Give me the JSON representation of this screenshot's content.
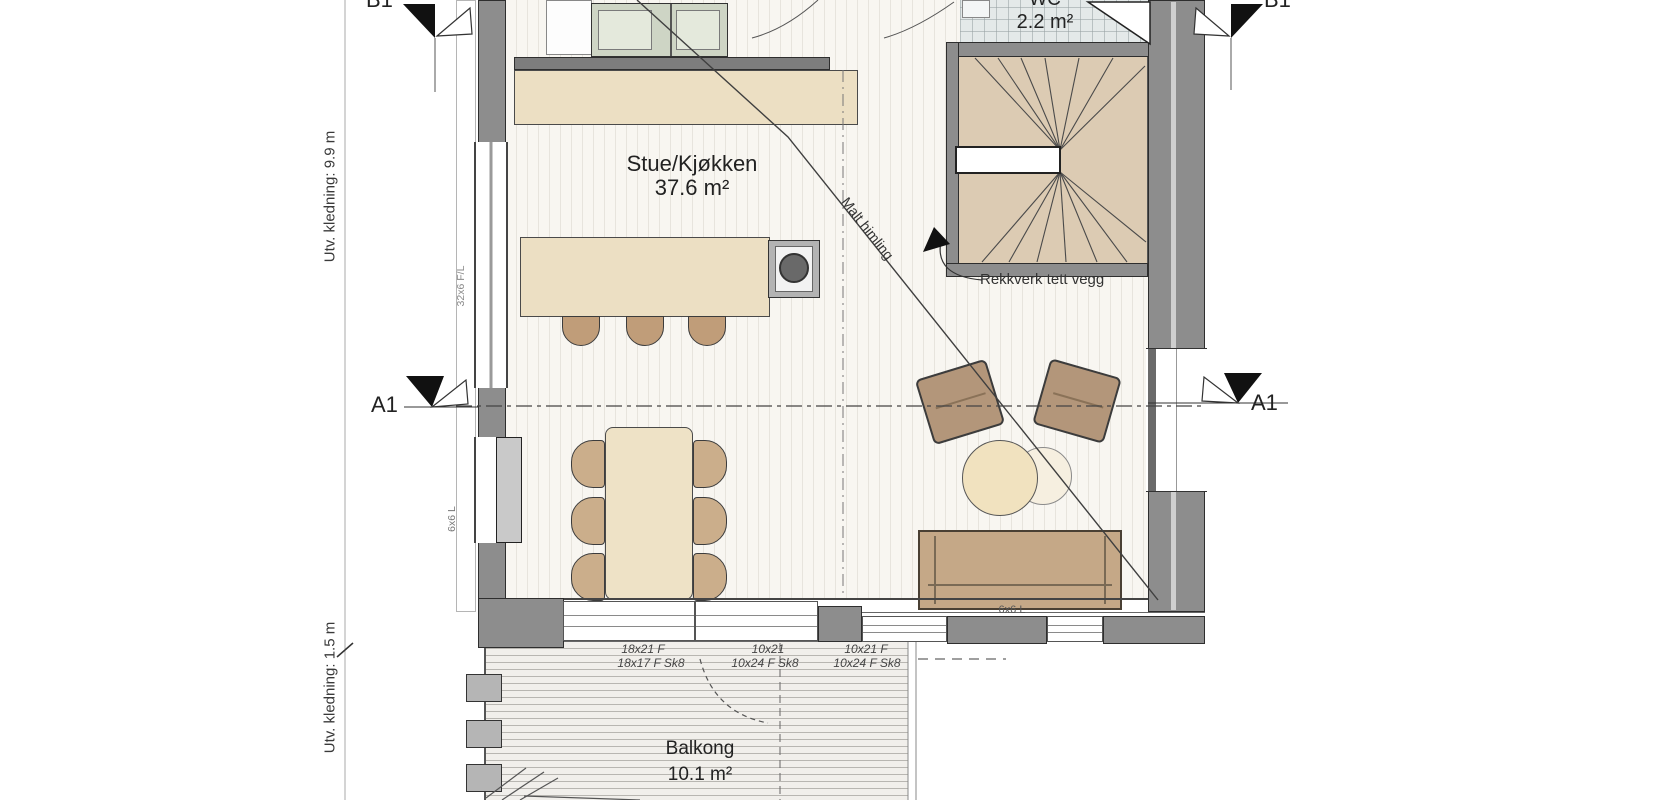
{
  "floorplan": {
    "rooms": {
      "living": {
        "name": "Stue/Kjøkken",
        "area": "37.6 m²"
      },
      "wc": {
        "name": "WC",
        "area": "2.2 m²"
      },
      "balcony": {
        "name": "Balkong",
        "area": "10.1 m²"
      }
    },
    "sections": {
      "a1": "A1",
      "b1": "B1"
    },
    "dimensions": {
      "cladding_top": "Utv. kledning: 9.9 m",
      "cladding_bottom": "Utv. kledning: 1.5 m"
    },
    "annotations": {
      "railing": "Rekkverk tett vegg",
      "ceiling": "Malt himling",
      "island_spec": "32x6 F/L",
      "vent_left": "6x6 L",
      "vent_bottom": "6x6 L"
    },
    "window_specs": {
      "row1": [
        "18x21 F",
        "10x21",
        "10x21 F"
      ],
      "row2": [
        "18x17 F Sk8",
        "10x24 F Sk8",
        "10x24 F Sk8"
      ]
    },
    "colors": {
      "wall": "#8d8d8d",
      "wood_light": "#ecdfc3",
      "furniture_tan": "#b3967a",
      "stairs": "#dccbb3",
      "cabinet_green": "#ced5c5",
      "wc_tile": "#e4e9e9"
    }
  }
}
